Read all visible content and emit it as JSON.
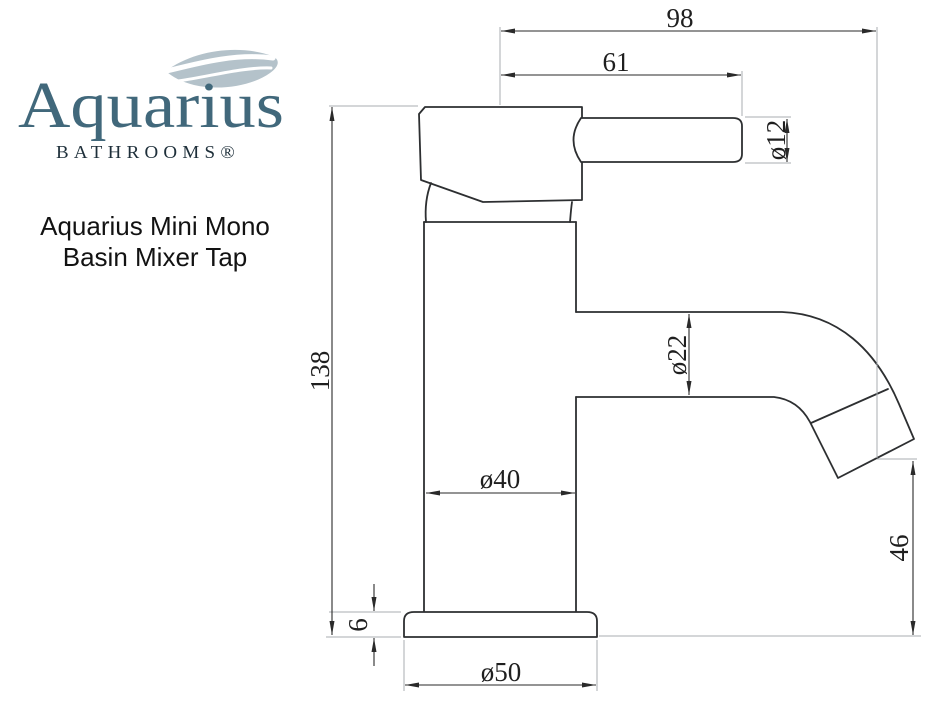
{
  "brand": {
    "name": "Aquarius",
    "tagline": "BATHROOMS®",
    "colors": {
      "brand_teal": "#41687b",
      "tagline_dark": "#1e2f3a",
      "wave_gray_blue": "#b4c2ca"
    }
  },
  "product_title": {
    "line1": "Aquarius Mini Mono",
    "line2": "Basin Mixer Tap"
  },
  "drawing": {
    "type": "technical-dimension-diagram",
    "subject": "basin mixer tap side elevation",
    "line_color": "#2d2f31",
    "extension_line_color": "#a8adb1",
    "dimensions": {
      "overall_reach": "98",
      "handle_reach": "61",
      "handle_diameter": "ø12",
      "overall_height": "138",
      "spout_diameter": "ø22",
      "body_diameter": "ø40",
      "spout_outlet_height": "46",
      "base_height": "6",
      "base_diameter": "ø50"
    }
  }
}
